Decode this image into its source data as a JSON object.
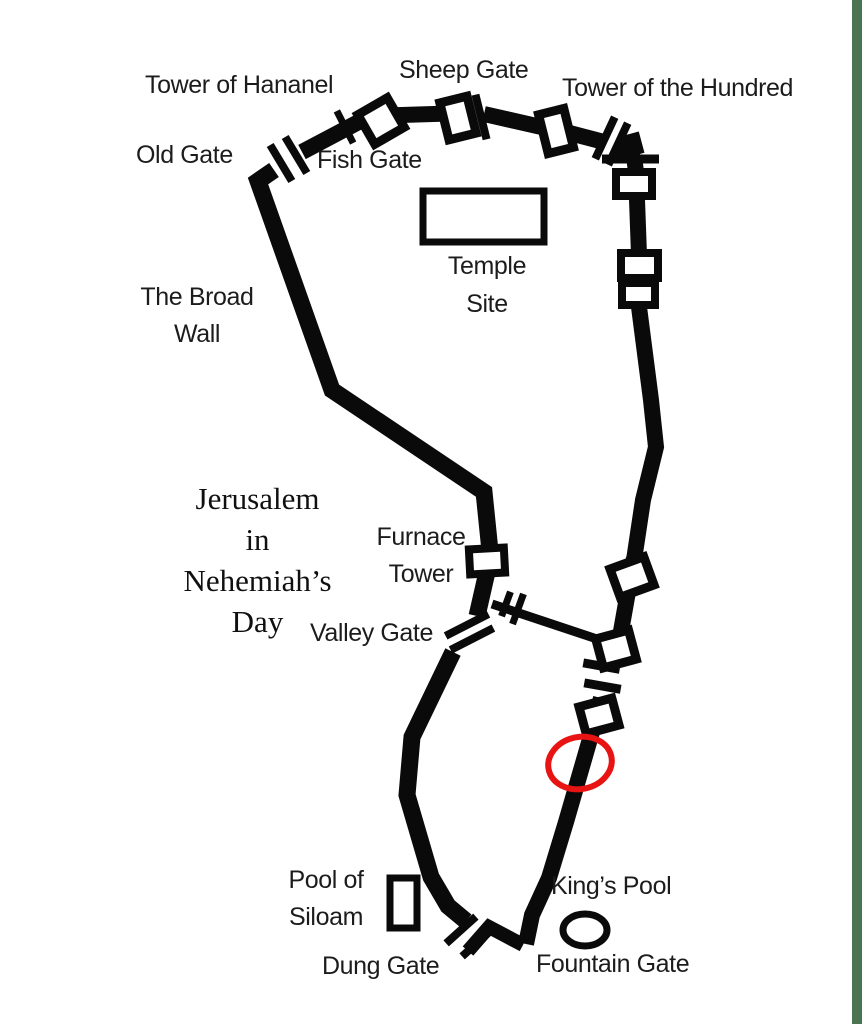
{
  "window": {
    "background_color": "#ffffff",
    "right_border_color": "#4b7450"
  },
  "map": {
    "title_lines": [
      "Jerusalem",
      "in",
      "Nehemiah’s",
      "Day"
    ],
    "wall_color": "#0a0a0a",
    "highlight_color": "#e81313",
    "labels": {
      "tower_of_hananel": "Tower of Hananel",
      "sheep_gate": "Sheep Gate",
      "tower_of_the_hundred": "Tower of the Hundred",
      "old_gate": "Old Gate",
      "fish_gate": "Fish Gate",
      "temple_site_line1": "Temple",
      "temple_site_line2": "Site",
      "broad_wall_line1": "The Broad",
      "broad_wall_line2": "Wall",
      "furnace_tower_line1": "Furnace",
      "furnace_tower_line2": "Tower",
      "valley_gate": "Valley Gate",
      "pool_of_siloam_line1": "Pool of",
      "pool_of_siloam_line2": "Siloam",
      "dung_gate": "Dung Gate",
      "kings_pool": "King’s Pool",
      "fountain_gate": "Fountain Gate"
    }
  }
}
